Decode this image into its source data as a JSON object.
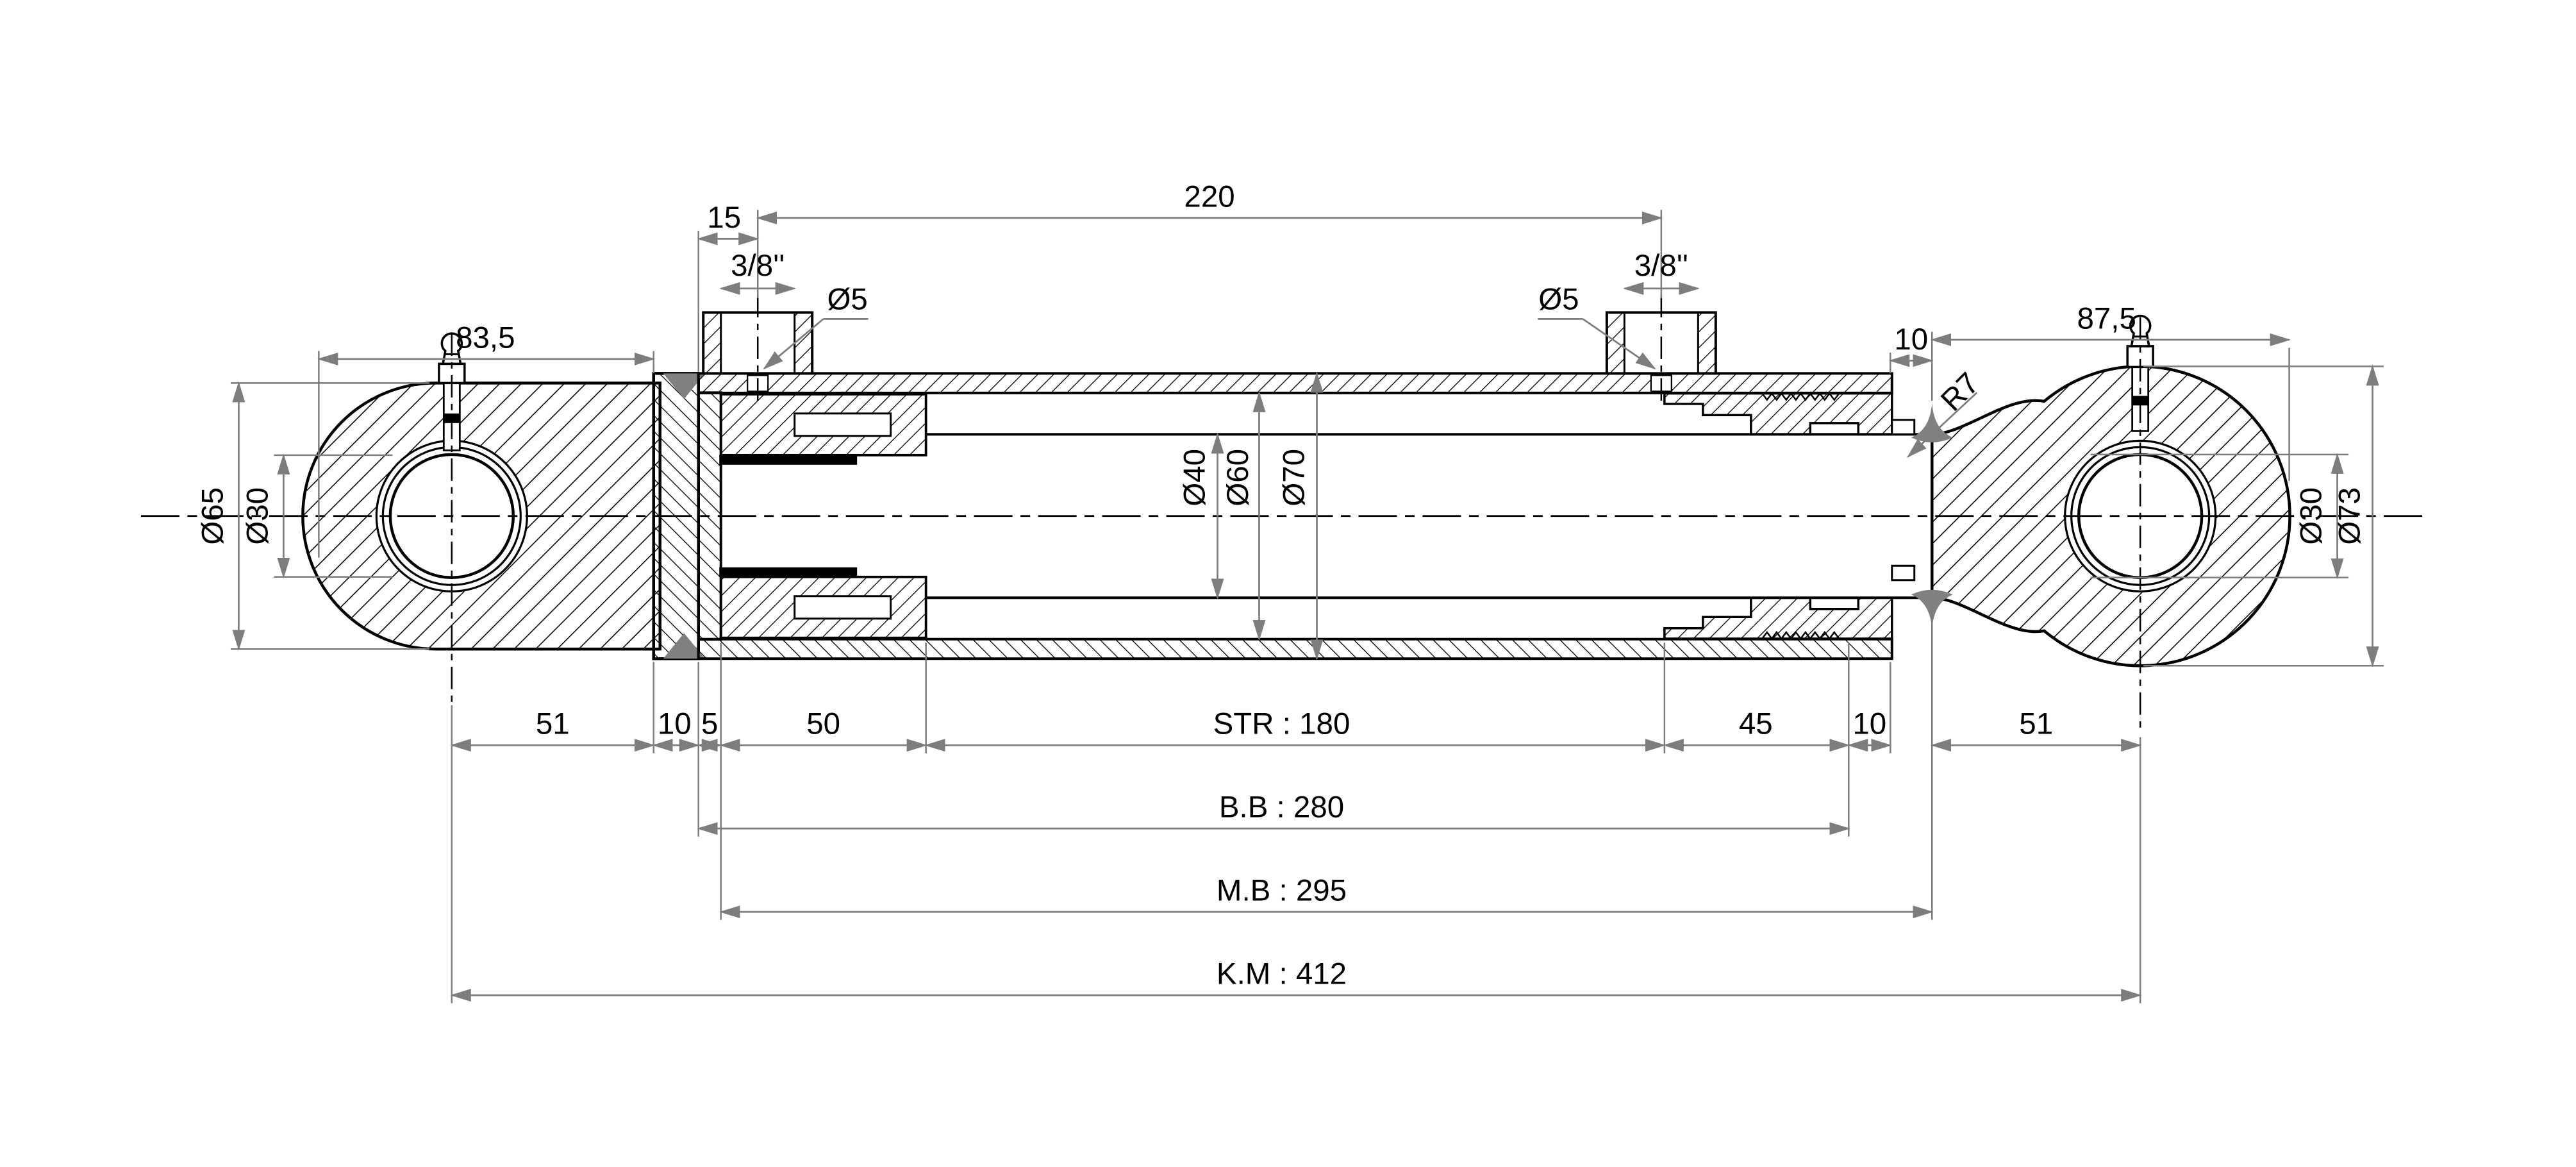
{
  "drawing": {
    "type": "hydraulic-cylinder-cross-section",
    "colors": {
      "outline": "#000000",
      "dimension_lines": "#7d7d7d",
      "weld_fill": "#808080",
      "seal_fill": "#000000",
      "paper": "#ffffff"
    },
    "top_dimensions": {
      "ports_span": "220",
      "port_offset": "15",
      "port_thread_left": "3/8''",
      "port_thread_right": "3/8''",
      "port_hole_left": "Ø5",
      "port_hole_right": "Ø5",
      "left_eye_width": "83,5",
      "right_eye_width": "87,5",
      "rod_exposed": "10",
      "weld_fillet": "R7"
    },
    "left_eye": {
      "outer_diameter": "Ø65",
      "bore_diameter": "Ø30"
    },
    "barrel": {
      "rod_diameter": "Ø40",
      "inner_diameter": "Ø60",
      "outer_diameter": "Ø70"
    },
    "right_eye": {
      "bore_diameter": "Ø30",
      "outer_diameter": "Ø73"
    },
    "bottom_dimensions": {
      "row1": [
        "51",
        "10",
        "5",
        "50",
        "STR : 180",
        "45",
        "10",
        "51"
      ],
      "row2": "B.B : 280",
      "row3": "M.B : 295",
      "row4": "K.M : 412"
    }
  }
}
